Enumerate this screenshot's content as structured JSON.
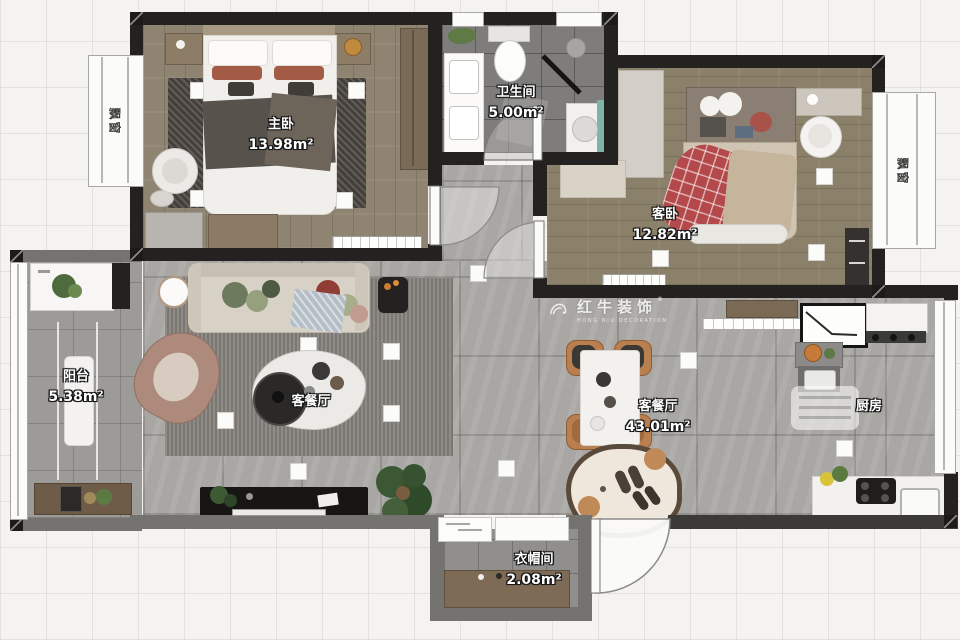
{
  "watermark": {
    "brand": "红牛装饰",
    "subtext": "HONG NIU DECORATION",
    "registered": "®"
  },
  "rooms": {
    "master": {
      "name": "主卧",
      "area": "13.98m²"
    },
    "bath": {
      "name": "卫生间",
      "area": "5.00m²"
    },
    "guest": {
      "name": "客卧",
      "area": "12.82m²"
    },
    "balcony": {
      "name": "阳台",
      "area": "5.38m²"
    },
    "living": {
      "name": "客餐厅",
      "area": "43.01m²"
    },
    "living_tag": {
      "name": "客餐厅"
    },
    "kitchen": {
      "name": "厨房"
    },
    "cloak": {
      "name": "衣帽间",
      "area": "2.08m²"
    },
    "bay_left": {
      "name": "飘窗"
    },
    "bay_right": {
      "name": "飘窗"
    }
  }
}
